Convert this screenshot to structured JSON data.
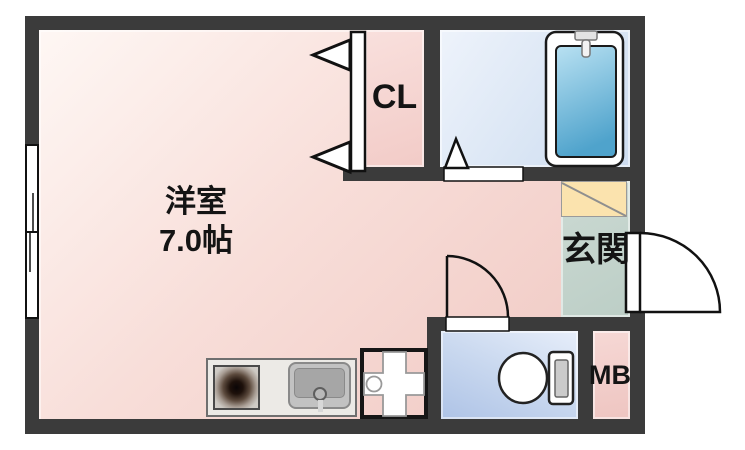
{
  "plan_title": "one-room apartment floor plan",
  "rooms": {
    "main": {
      "name": "洋室",
      "size": "7.0帖"
    },
    "closet": {
      "label": "CL"
    },
    "entrance": {
      "label": "玄関"
    },
    "meter_box": {
      "label": "MB"
    }
  },
  "colors": {
    "wall": "#3b3b3b",
    "main_room_pink": "#efc7c1",
    "closet_pink": "#f2cbc7",
    "bathroom_blue": "#d9e5f4",
    "bathtub_blue": "#4fa3cc",
    "entrance_floor_green": "#c2d2ca",
    "entrance_step_yellow": "#fbe3ae",
    "toilet_floor_blue": "#bdcfeb",
    "meter_box_pink": "#f0cbc7",
    "kitchen_counter_gray": "#eceae6",
    "outline_black": "#111111"
  },
  "fixtures": [
    {
      "name": "sliding-window"
    },
    {
      "name": "closet-folding-door"
    },
    {
      "name": "bathtub"
    },
    {
      "name": "bathtub-faucet"
    },
    {
      "name": "bathroom-door"
    },
    {
      "name": "entrance-door"
    },
    {
      "name": "toilet"
    },
    {
      "name": "toilet-door"
    },
    {
      "name": "kitchen-stove"
    },
    {
      "name": "kitchen-sink"
    },
    {
      "name": "washing-machine-pan"
    }
  ]
}
